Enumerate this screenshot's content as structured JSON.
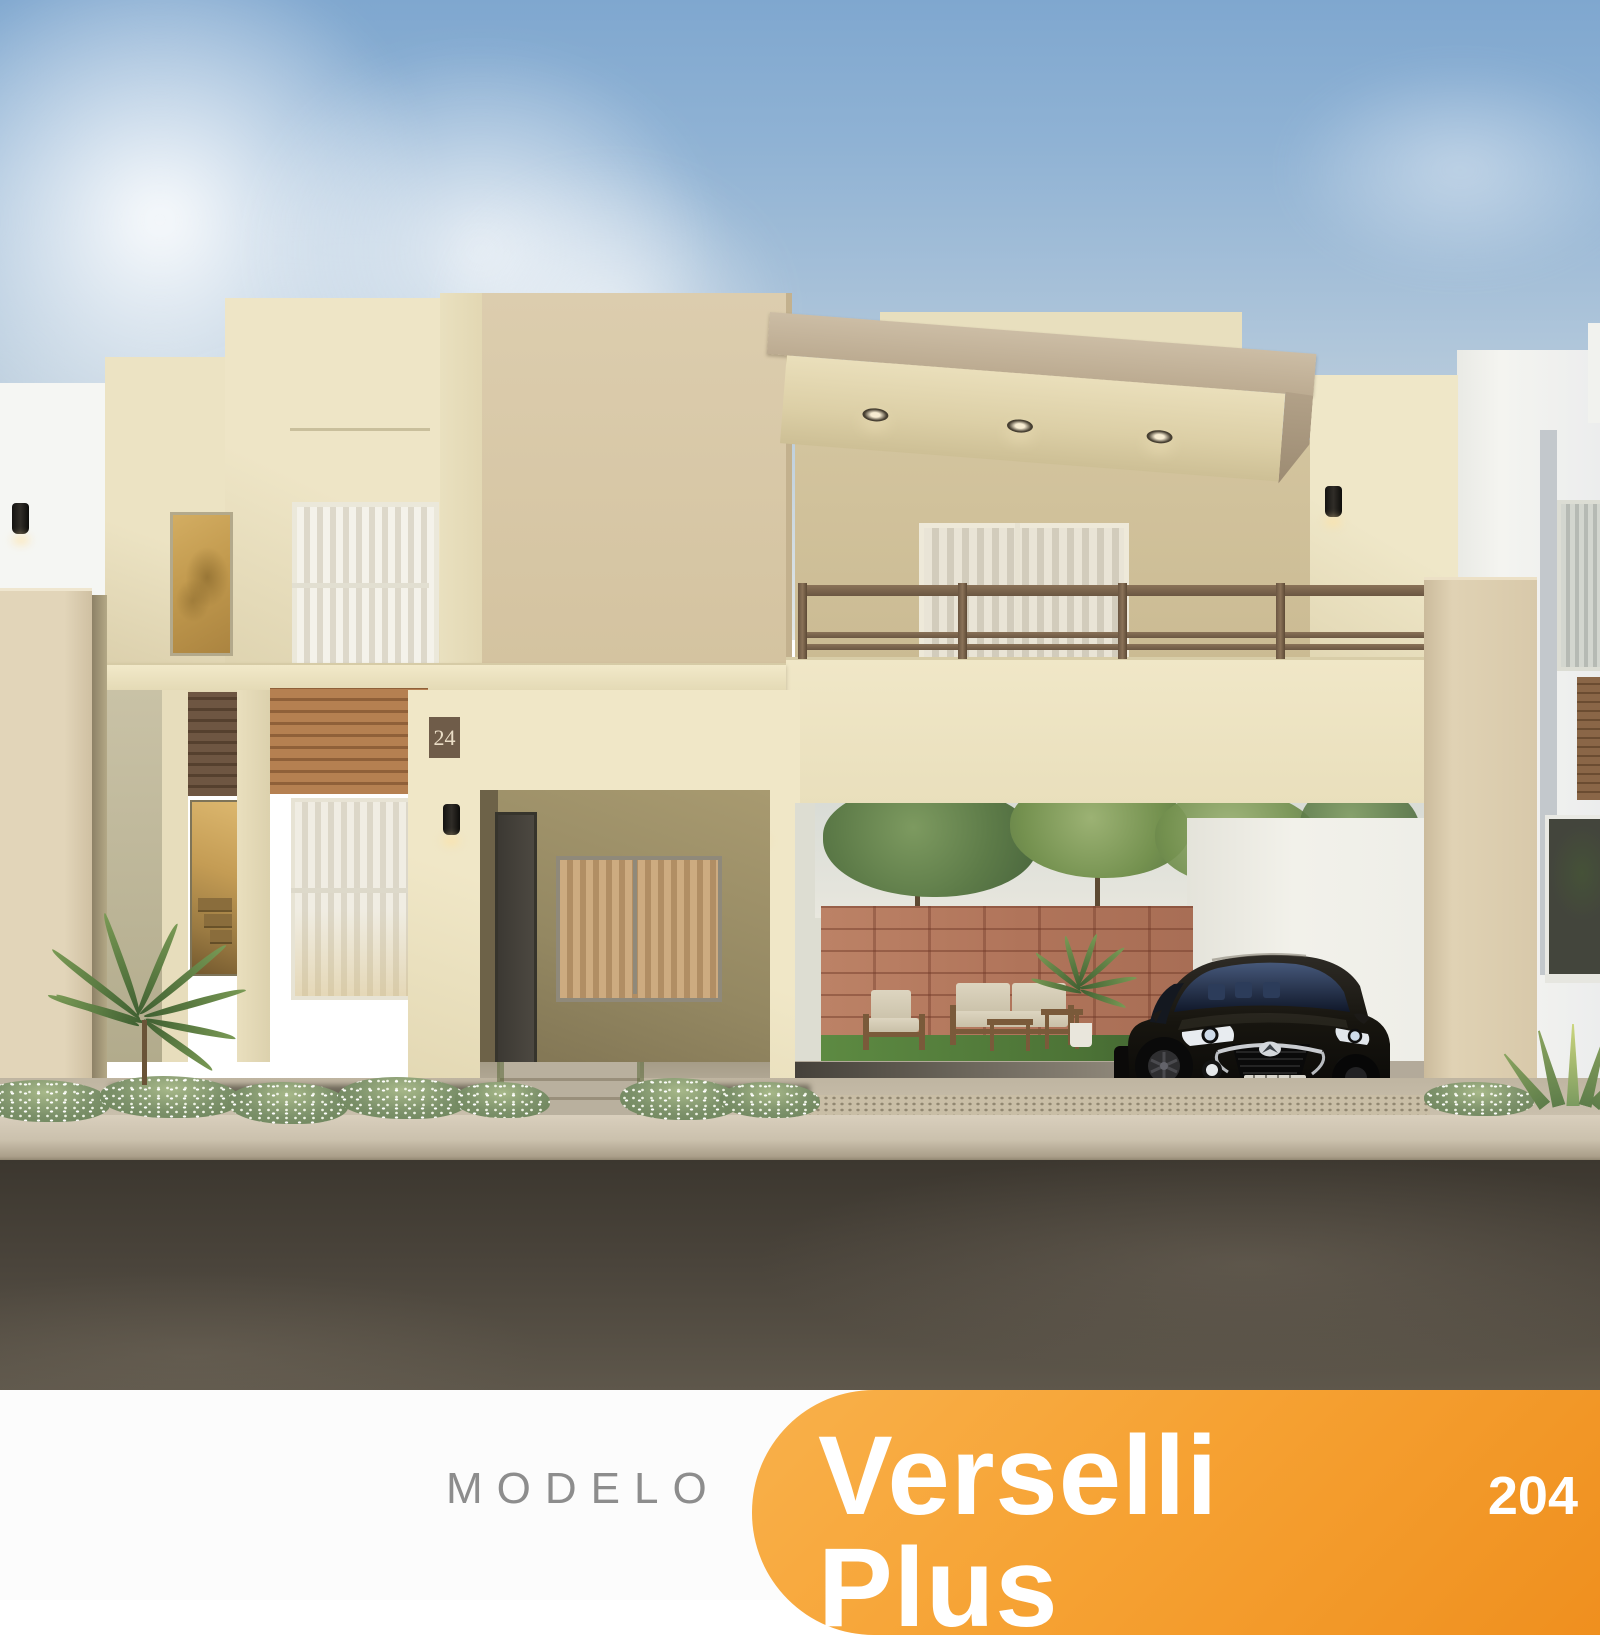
{
  "banner": {
    "modelo_label": "MODELO",
    "model_name": "Verselli Plus",
    "model_number": "204",
    "label_color": "#8D8D8D",
    "orange_gradient_start": "#F9B14B",
    "orange_gradient_end": "#EF8F1E",
    "band_color": "#FCFCFC"
  },
  "house": {
    "number_plaque": "24",
    "plaque_color": "#6F5C49",
    "wall_cream": "#ECE3C4",
    "textured_stucco": "#D8C9AB",
    "stone_pillar": "#DCCEB0",
    "railing_brown": "#77614C",
    "brick_wall": "#B97F63",
    "lawn_green": "#55813E",
    "asphalt": "#4A443B",
    "sky_blue": "#84ABD1"
  }
}
